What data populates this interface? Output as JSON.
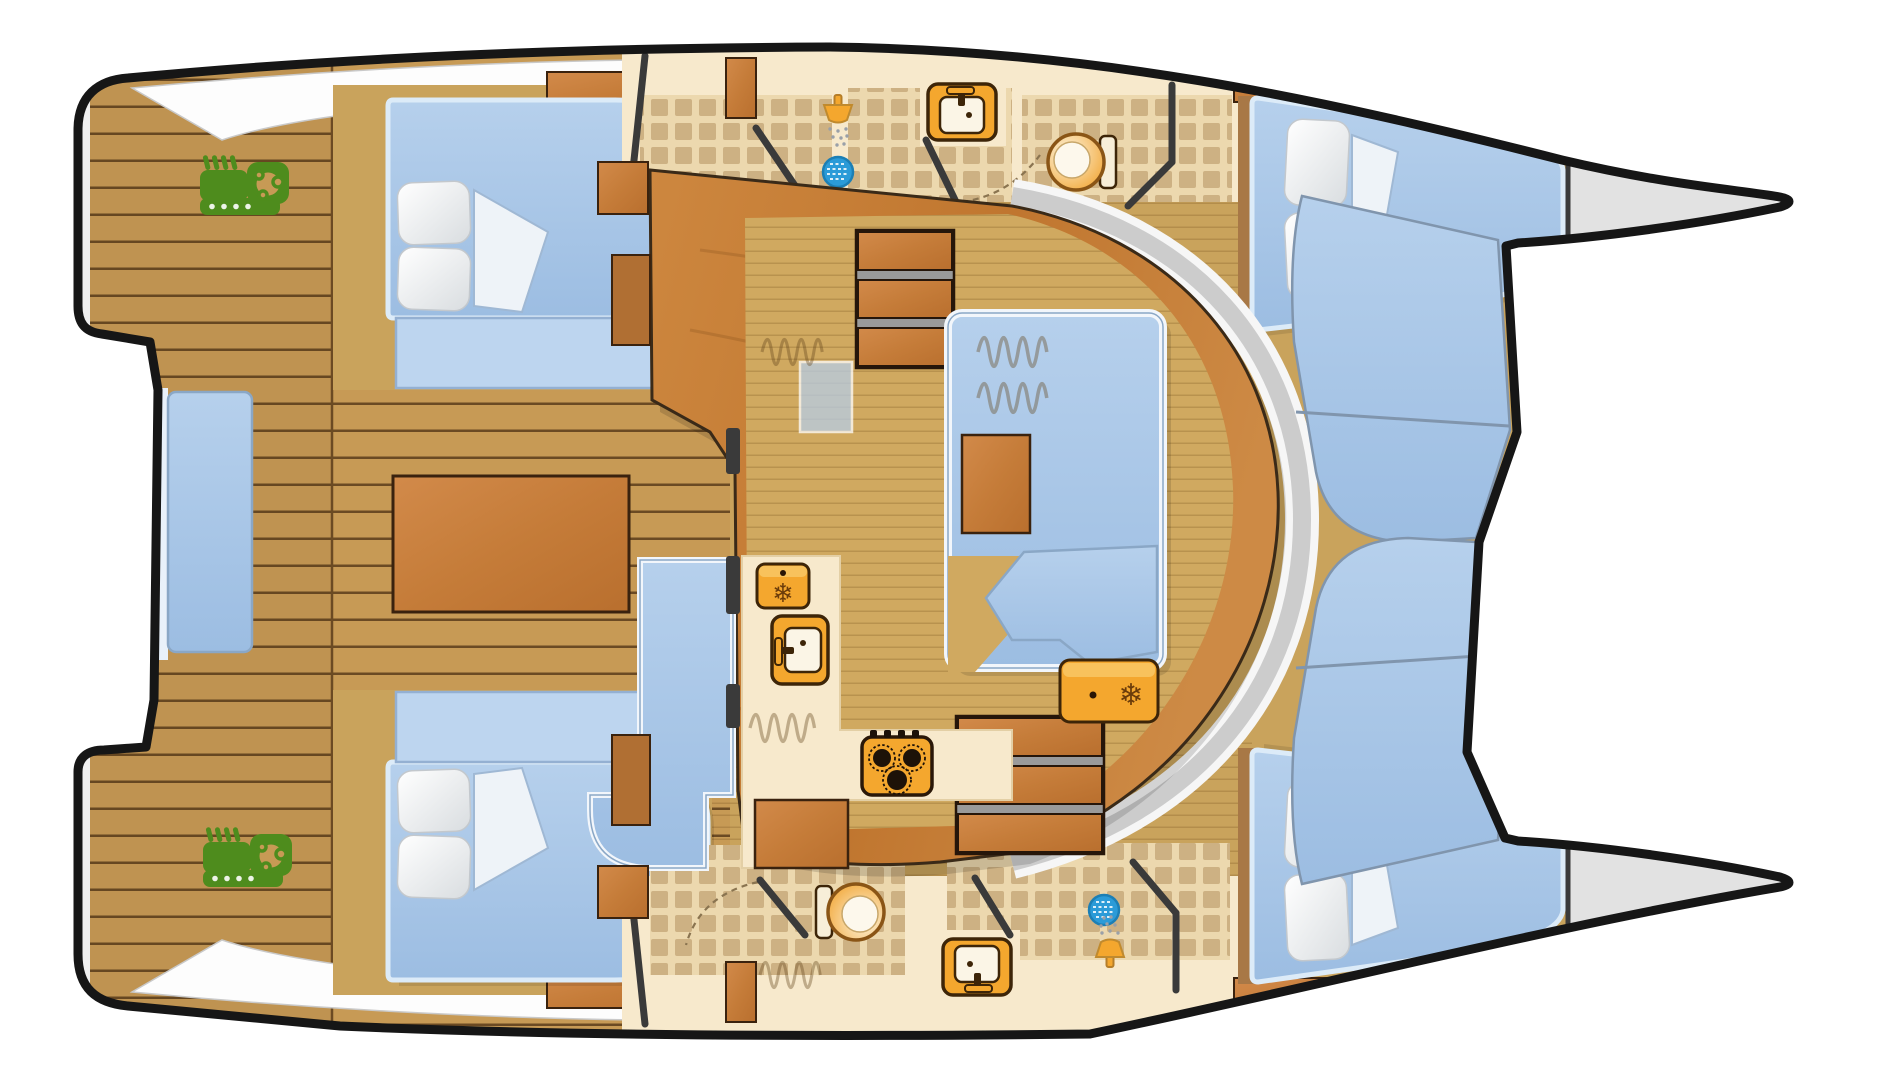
{
  "title": "Catamaran interior layout — overhead floor plan",
  "palette": {
    "hull_outline": "#161616",
    "hull_deck": "#f0f0f0",
    "bow_gray": "#e2e2e2",
    "teak": "#c79a55",
    "plank_line": "#6b4a23",
    "sole": "#c9a35c",
    "salon_floor": "#d0a960",
    "coachroof": "#c67c38",
    "furniture_wood": "#c57e3e",
    "cushion": "#a9c7e8",
    "cushion_light": "#bdd5ef",
    "cushion_edge": "#8aa7c6",
    "pillow": "#f5f6f7",
    "cream": "#f7e9cc",
    "tile": "#cdb183",
    "fixture": "#f4a72e",
    "fixture_dark": "#3d2508",
    "engine": "#4e8c1d",
    "drain": "#2b9bd8",
    "wall": "#3a3a3a",
    "walkway": "#cccccc",
    "white_trim": "#f2f6fb"
  },
  "vessel": {
    "type": "catamaran",
    "view": "top-down-floor-plan",
    "hulls": [
      {
        "id": "port-hull",
        "aft_deck": [
          "teak-planking",
          "engine"
        ],
        "aft_cabin": [
          "double-berth",
          "pillow",
          "bench"
        ],
        "bathroom": [
          "shower",
          "shower-drain",
          "sink",
          "toilet",
          "tiled-floor"
        ],
        "forward_cabin": [
          "double-berth",
          "pillow",
          "pillow"
        ],
        "bow": "anchor-locker"
      },
      {
        "id": "starboard-hull",
        "aft_deck": [
          "teak-planking",
          "engine"
        ],
        "aft_cabin": [
          "double-berth",
          "pillow",
          "bench"
        ],
        "bathroom": [
          "toilet",
          "sink",
          "shower",
          "shower-drain",
          "tiled-floor"
        ],
        "forward_cabin": [
          "double-berth",
          "pillow",
          "pillow"
        ],
        "bow": "anchor-locker"
      }
    ],
    "bridgedeck": {
      "aft_cockpit": [
        "cockpit-table",
        "l-sofa",
        "side-bench",
        "cabin-top-bench",
        "cabin-top-bench"
      ],
      "salon": [
        "companionway-stairs-port",
        "companionway-stairs-starboard",
        "u-dinette-sofa",
        "coffee-table",
        "chaise-seat",
        "freezer",
        "floor-hatch"
      ],
      "galley": [
        "fridge",
        "galley-sink",
        "stove",
        "cabinet",
        "backsplash"
      ],
      "forward_cockpit": [
        "curved-bench-port",
        "curved-bench-starboard",
        "walkway"
      ]
    },
    "fixture_counts": {
      "engines": 2,
      "showers": 2,
      "toilets": 2,
      "sinks": 3,
      "stoves": 1,
      "fridges": 1,
      "freezers": 1,
      "berths": 4,
      "stairs": 2
    }
  },
  "icons": {
    "engine": "engine-icon",
    "shower": "shower-head-icon",
    "drain": "shower-drain-icon",
    "toilet": "toilet-icon",
    "sink": "sink-icon",
    "stove": "stove-icon",
    "fridge": "fridge-icon",
    "freezer": "freezer-icon",
    "snowflake_glyph": "❄"
  }
}
